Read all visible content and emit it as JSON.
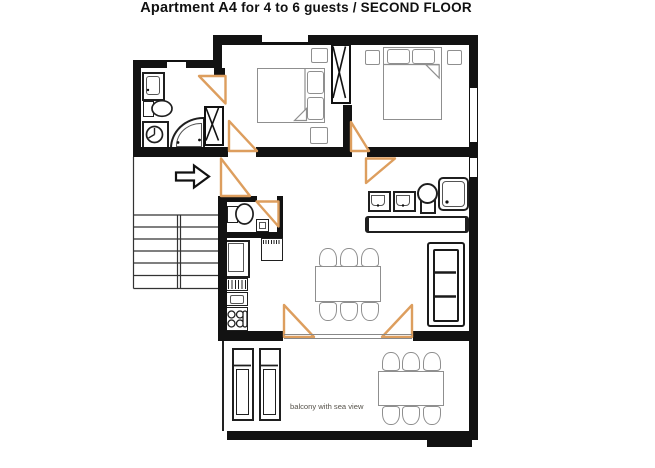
{
  "title": {
    "apartment": "Apartment A4",
    "details": " for 4 to 6 guests / SECOND FLOOR"
  },
  "balcony": {
    "label": "balcony with sea view"
  },
  "theme": {
    "wall_color": "#121212",
    "door_color": "#dd9e5e",
    "furniture_color": "#8f8f8f",
    "fixture_color": "#1f1f1f"
  }
}
